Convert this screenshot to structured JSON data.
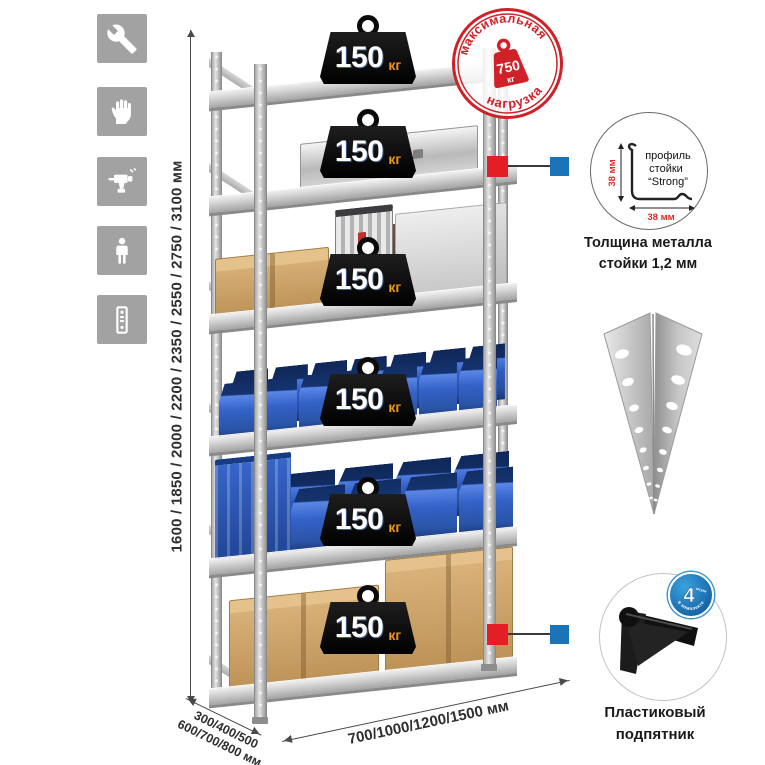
{
  "tools_icons": {
    "items": [
      {
        "name": "wrench"
      },
      {
        "name": "gloves"
      },
      {
        "name": "drill"
      },
      {
        "name": "person-height"
      },
      {
        "name": "rack-post"
      }
    ]
  },
  "dimensions": {
    "height": "1600 / 1850 / 2000 / 2200 / 2350 / 2550 / 2750 / 3100 мм",
    "depth_line1": "300/400/500",
    "depth_line2": "600/700/800 мм",
    "width": "700/1000/1200/1500 мм"
  },
  "rack": {
    "shelves": [
      {
        "load": "150",
        "unit": "кг"
      },
      {
        "load": "150",
        "unit": "кг"
      },
      {
        "load": "150",
        "unit": "кг"
      },
      {
        "load": "150",
        "unit": "кг"
      },
      {
        "load": "150",
        "unit": "кг"
      },
      {
        "load": "150",
        "unit": "кг"
      }
    ]
  },
  "max_load_stamp": {
    "arc_top": "максимальная",
    "arc_bottom": "нагрузка",
    "value": "750",
    "unit": "кг"
  },
  "profile_callout": {
    "line1": "профиль",
    "line2": "стойки",
    "line3": "“Strong”",
    "dim_vertical": "38 мм",
    "dim_horizontal": "38 мм",
    "caption1": "Толщина металла",
    "caption2": "стойки 1,2 мм"
  },
  "foot_callout": {
    "badge_value": "4",
    "badge_small": "штуки",
    "badge_arc": "в комплекте",
    "caption1": "Пластиковый",
    "caption2": "подпятник"
  },
  "colors": {
    "stamp_red": "#cf2127",
    "marker_red": "#e31e25",
    "marker_blue": "#1c74b8",
    "bin_blue": "#2b57b8",
    "weight_orange": "#f0931f",
    "icon_gray": "#a2a2a2"
  }
}
